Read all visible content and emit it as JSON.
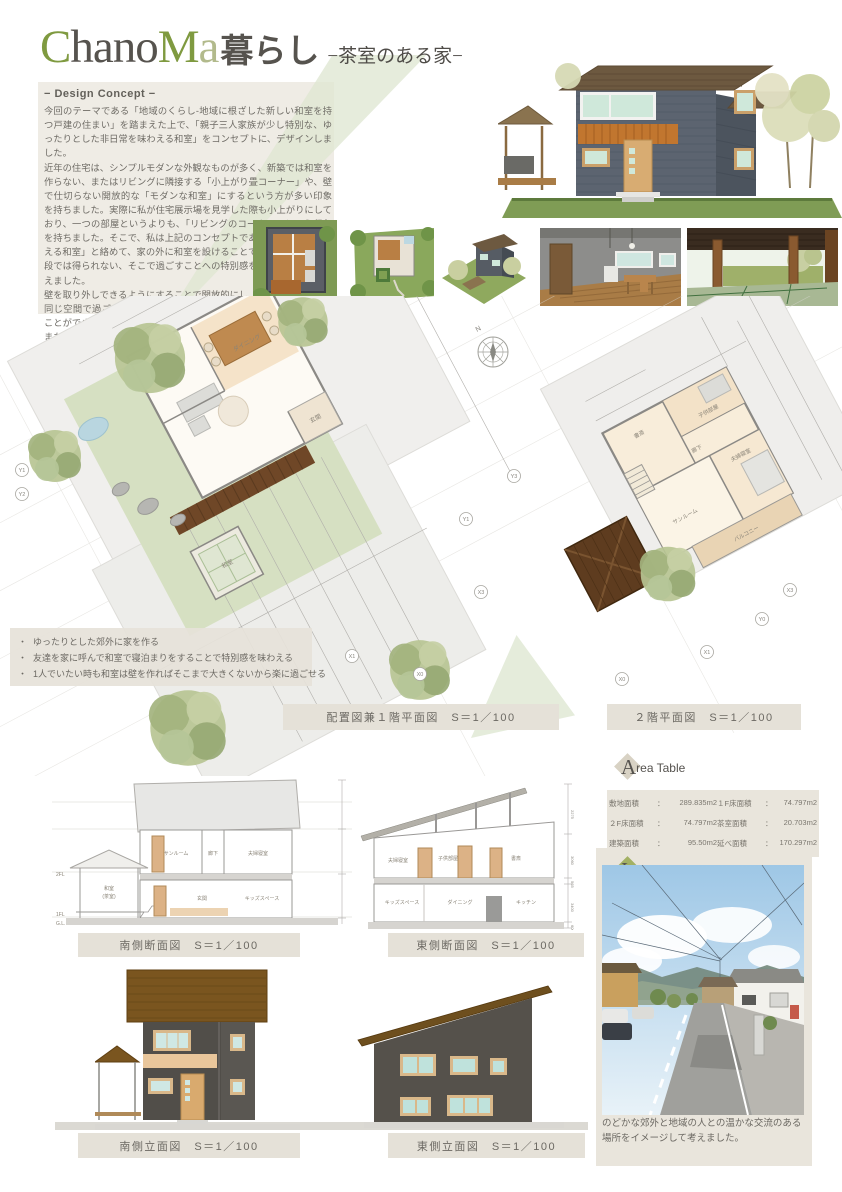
{
  "colors": {
    "accent_green": "#7f9a40",
    "sage": "#dfe7d2",
    "beige_panel": "#e5e1d8",
    "roof_brown": "#7a551f",
    "wall_dark": "#55514b",
    "wood_orange": "#c1762f",
    "tatami_green": "#cfe0c2",
    "mint_window": "#cfe8e4"
  },
  "header": {
    "title_c": "C",
    "title_hano": "hano",
    "title_m": "M",
    "title_a": "a",
    "title_suffix": "暮らし",
    "subtitle": "−茶室のある家−"
  },
  "concept": {
    "heading": "− Design Concept −",
    "paragraphs": [
      "今回のテーマである「地域のくらし-地域に根ざした新しい和室を持つ戸建の住まい」を踏まえた上で、「親子三人家族が少し特別な、ゆったりとした非日常を味わえる和室」をコンセプトに、デザインしました。",
      "近年の住宅は、シンプルモダンな外観なものが多く、新築では和室を作らない、またはリビングに隣接する「小上がり畳コーナー」や、壁で仕切らない開放的な「モダンな和室」にするという方が多い印象を持ちました。実際に私が住宅展示場を見学した際も小上がりにしており、一つの部屋というよりも、「リビングのコーナー」という印象を持ちました。そこで、私は上記のコンセプトである「非日常を味わえる和室」と絡めて、家の外に和室を設けることで和室の独自性と普段では得られない、そこで過ごすことへの特別感を持てるのではと考えました。",
      "壁を取り外しできるようにすることで開放的にし、庭に居る家族とも同じ空間で過ごせるようにしました。庭の景色もゆったりと楽しむことができます。",
      "また、壁がないことで、外の景色を広々とみることができ、夏の花火大会の様子を和室から見ることで、家族だけのプライベート空間を確保できます。"
    ]
  },
  "bullets": {
    "dot": "・",
    "items": [
      "ゆったりとした郊外に家を作る",
      "友達を家に呼んで和室で寝泊まりをすることで特別感を味わえる",
      "1人でいたい時も和室は壁を作ればそこまで大きくないから楽に過ごせる"
    ]
  },
  "plans": {
    "label_1f": "配置図兼１階平面図　S＝1／100",
    "label_2f": "２階平面図　S＝1／100",
    "north": "N",
    "axes": [
      "Y1",
      "Y2",
      "X1",
      "X3",
      "X0",
      "Y3",
      "Y1",
      "X1",
      "Y0",
      "X0",
      "X3"
    ],
    "rooms_1f": [
      "ダイニング",
      "玄関",
      "和室"
    ],
    "rooms_2f": [
      "書斎",
      "子供部屋",
      "廊下",
      "夫婦寝室",
      "サンルーム",
      "バルコニー"
    ]
  },
  "area_table": {
    "initial": "A",
    "title_rest": "rea Table",
    "rows": [
      [
        "敷地面積",
        "：",
        "289.835m2",
        "１F床面積",
        "：",
        "74.797m2"
      ],
      [
        "２F床面積",
        "：",
        "74.797m2",
        "茶室面積",
        "：",
        "20.703m2"
      ],
      [
        "建築面積",
        "：",
        "95.50m2",
        "延べ面積",
        "：",
        "170.297m2"
      ]
    ]
  },
  "imaging": {
    "initial": "I",
    "title_rest": "maging Place",
    "caption": "のどかな郊外と地域の人との温かな交流のある場所をイメージして考えました。"
  },
  "sections": {
    "south": {
      "label": "南側断面図　S＝1／100",
      "rooms": [
        "サンルーム",
        "廊下",
        "夫婦寝室",
        "玄関",
        "キッズスペース"
      ],
      "tearoom_1": "和室",
      "tearoom_2": "(茶室)",
      "levels": [
        "2FL",
        "1FL",
        "G.L."
      ]
    },
    "east": {
      "label": "東側断面図　S＝1／100",
      "rooms": [
        "夫婦寝室",
        "子供部屋",
        "書斎",
        "キッズスペース",
        "ダイニング",
        "キッチン"
      ],
      "dims": [
        "2275",
        "3060",
        "565",
        "3400",
        "600"
      ]
    }
  },
  "elevations": {
    "south_label": "南側立面図　S＝1／100",
    "east_label": "東側立面図　S＝1／100"
  }
}
